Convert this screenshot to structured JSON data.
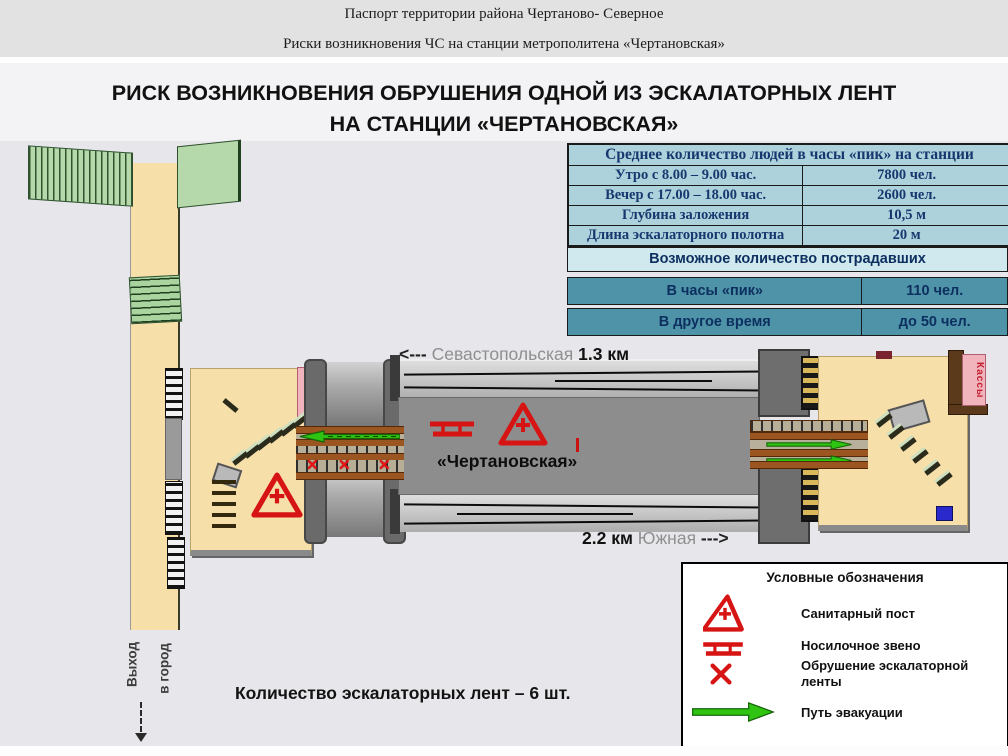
{
  "header": {
    "line1": "Паспорт территории района Чертаново- Северное",
    "line2": "Риски возникновения ЧС на станции метрополитена «Чертановская»"
  },
  "title": {
    "line1": "РИСК ВОЗНИКНОВЕНИЯ ОБРУШЕНИЯ ОДНОЙ ИЗ ЭСКАЛАТОРНЫХ ЛЕНТ",
    "line2": "НА СТАНЦИИ «ЧЕРТАНОВСКАЯ»"
  },
  "stats_table": {
    "title": "Среднее количество людей в часы «пик» на станции",
    "rows": [
      {
        "label": "Утро с 8.00 – 9.00 час.",
        "value": "7800 чел."
      },
      {
        "label": "Вечер с 17.00 – 18.00 час.",
        "value": "2600 чел."
      },
      {
        "label": "Глубина заложения",
        "value": "10,5 м"
      },
      {
        "label": "Длина эскалаторного полотна",
        "value": "20 м"
      }
    ]
  },
  "casualties_table": {
    "title": "Возможное количество пострадавших",
    "rows": [
      {
        "label": "В часы «пик»",
        "value": "110 чел."
      },
      {
        "label": "В другое время",
        "value": "до 50 чел."
      }
    ]
  },
  "diagram": {
    "station_label": "«Чертановская»",
    "north_neighbor": {
      "arrow": "<---",
      "name": "Севастопольская",
      "distance": "1.3 км"
    },
    "south_neighbor": {
      "distance": "2.2 км",
      "name": "Южная",
      "arrow": "--->"
    },
    "ticket_office_left": "Кассы",
    "ticket_office_right": "Кассы",
    "exit": {
      "line1": "Выход",
      "line2": "в город"
    }
  },
  "legend": {
    "title": "Условные обозначения",
    "items": [
      {
        "icon": "sanitary-post-icon",
        "label": "Санитарный пост"
      },
      {
        "icon": "stretcher-icon",
        "label": "Носилочное звено"
      },
      {
        "icon": "escalator-collapse-icon",
        "label": "Обрушение эскалаторной ленты"
      },
      {
        "icon": "evacuation-path-icon",
        "label": "Путь эвакуации"
      }
    ]
  },
  "footer": {
    "note": "Количество эскалаторных лент – 6 шт."
  },
  "colors": {
    "accent_red": "#d21414",
    "evacuation_green": "#2ec411",
    "table_blue_light": "#aed2dc",
    "table_teal": "#4e93a8",
    "vestibule_beige": "#f7dfa9",
    "platform_gray": "#8d8d8d"
  }
}
